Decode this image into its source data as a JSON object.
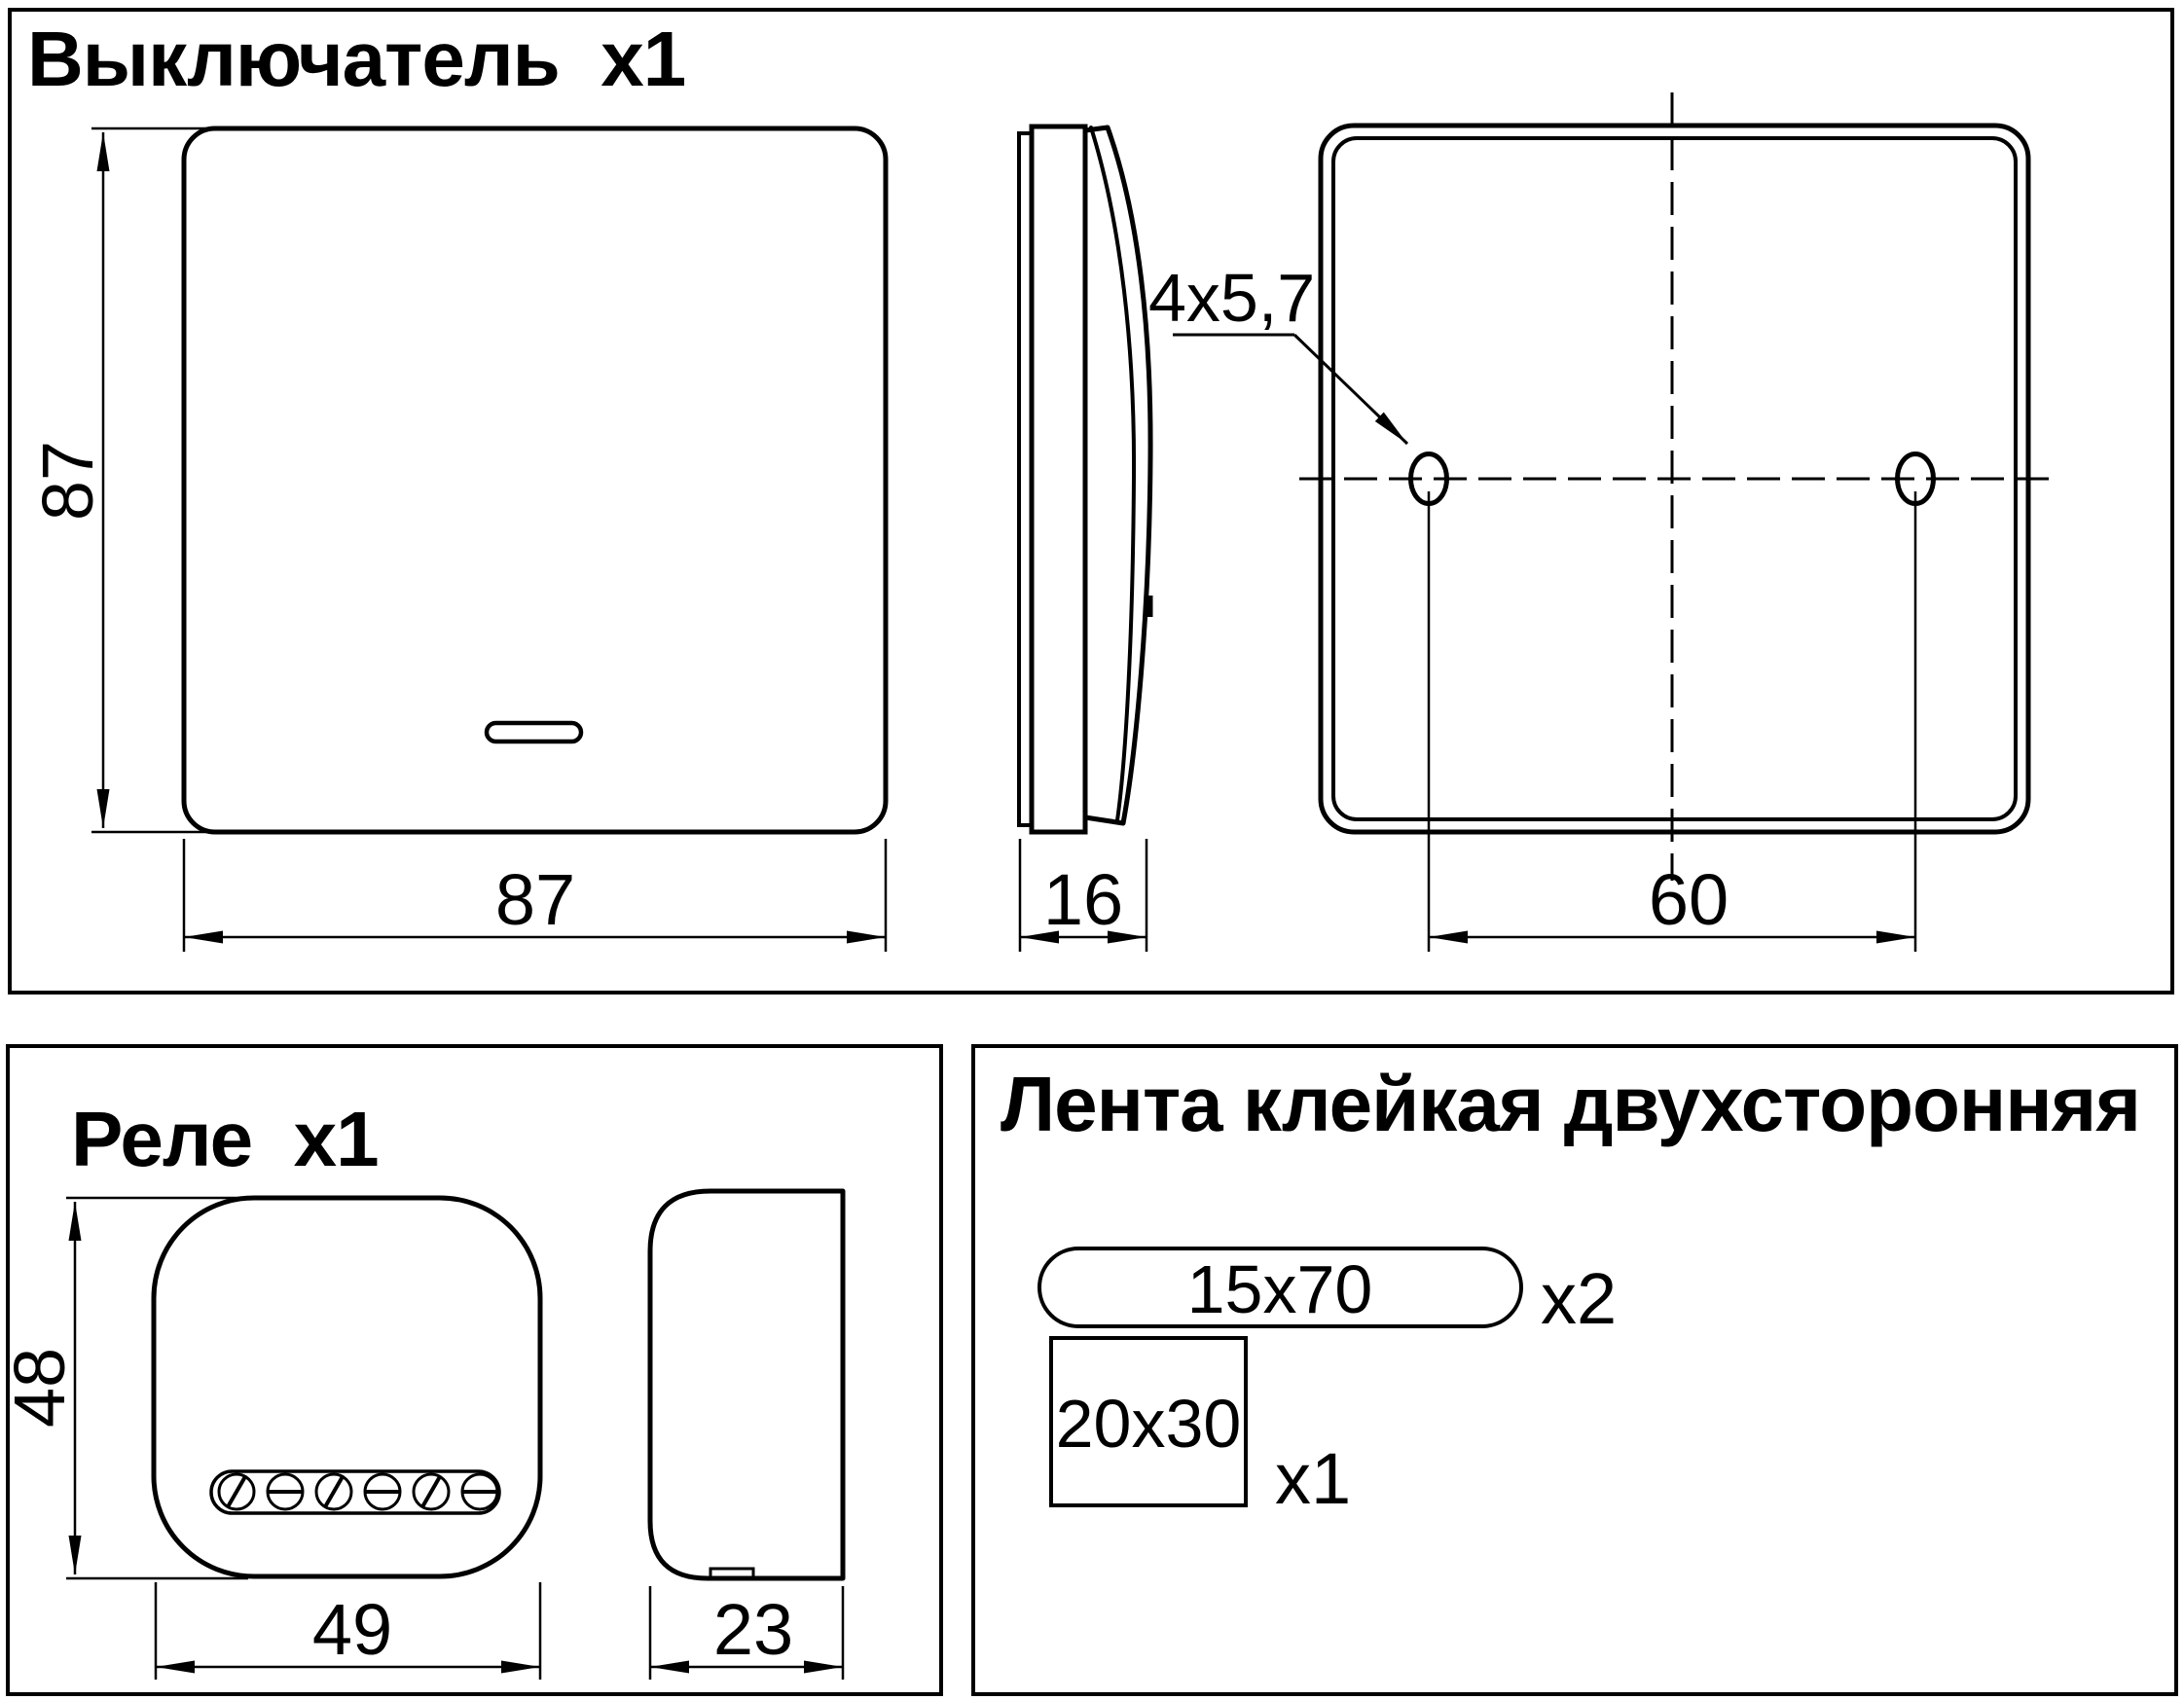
{
  "colors": {
    "ink": "#000000",
    "background": "#ffffff"
  },
  "switch": {
    "title": "Выключатель  x1",
    "front": {
      "height_label": "87",
      "width_label": "87"
    },
    "side": {
      "depth_label": "16"
    },
    "back": {
      "holes_label": "4x5,7",
      "hole_spacing_label": "60"
    }
  },
  "relay": {
    "title": "Реле  x1",
    "front": {
      "height_label": "48",
      "width_label": "49"
    },
    "side": {
      "depth_label": "23"
    }
  },
  "tape": {
    "title": "Лента клейкая двухсторонняя",
    "strip": {
      "size_label": "15x70",
      "qty_label": "x2"
    },
    "pad": {
      "size_label": "20x30",
      "qty_label": "x1"
    }
  }
}
